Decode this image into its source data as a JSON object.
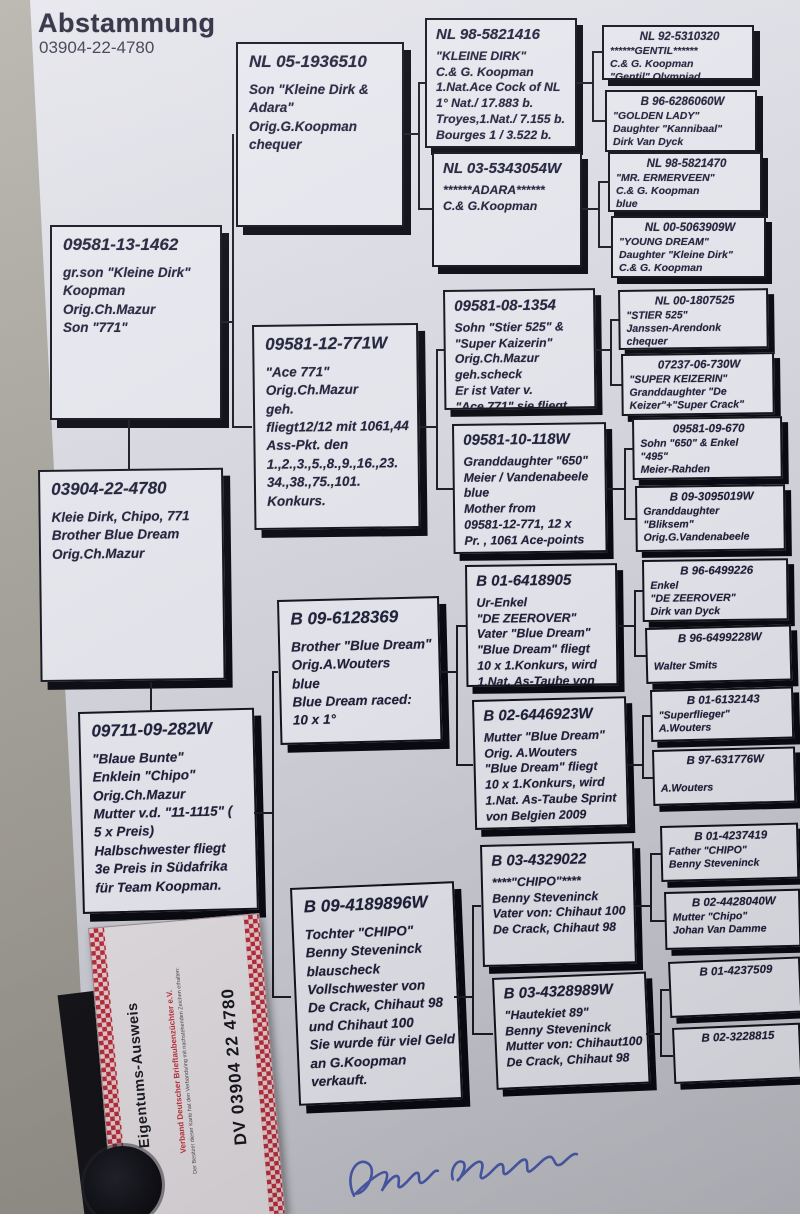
{
  "title": {
    "heading": "Abstammung",
    "ring_number": "03904-22-4780"
  },
  "colors": {
    "paper": "#dbdbe4",
    "box_border": "#14141e",
    "card_red": "#b8303c",
    "signature_blue": "#3c50aa"
  },
  "tree": {
    "sire": {
      "id": "09581-13-1462",
      "lines": [
        "gr.son \"Kleine Dirk\"",
        "Koopman",
        "Orig.Ch.Mazur",
        "Son \"771\""
      ]
    },
    "subject": {
      "id": "03904-22-4780",
      "lines": [
        "Kleie Dirk, Chipo, 771",
        "Brother Blue Dream",
        "Orig.Ch.Mazur"
      ]
    },
    "dam": {
      "id": "09711-09-282W",
      "lines": [
        "\"Blaue Bunte\"",
        "Enklein \"Chipo\"",
        "Orig.Ch.Mazur",
        "Mutter v.d. \"11-1115\" (",
        "5 x Preis)",
        "Halbschwester fliegt",
        "3e Preis in Südafrika",
        "für Team Koopman."
      ]
    },
    "g3": [
      {
        "id": "NL 05-1936510",
        "lines": [
          "Son \"Kleine Dirk &",
          "Adara\"",
          "Orig.G.Koopman",
          "chequer"
        ]
      },
      {
        "id": "09581-12-771W",
        "lines": [
          "\"Ace 771\"",
          "Orig.Ch.Mazur",
          "geh.",
          "fliegt12/12 mit 1061,44",
          "Ass-Pkt. den",
          "1.,2.,3.,5.,8.,9.,16.,23.",
          "34.,38.,75.,101.",
          "Konkurs."
        ]
      },
      {
        "id": "B 09-6128369",
        "lines": [
          "Brother \"Blue Dream\"",
          "Orig.A.Wouters",
          "blue",
          "Blue Dream raced:",
          "10 x 1°"
        ]
      },
      {
        "id": "B 09-4189896W",
        "lines": [
          "Tochter \"CHIPO\"",
          "Benny Steveninck",
          "blauscheck",
          "Vollschwester von",
          "De Crack, Chihaut 98",
          "und Chihaut 100",
          "Sie wurde für viel Geld",
          "an G.Koopman",
          "verkauft."
        ]
      }
    ],
    "g4": [
      {
        "id": "NL 98-5821416",
        "lines": [
          "\"KLEINE DIRK\"",
          "C.& G. Koopman",
          "1.Nat.Ace Cock of NL",
          "1° Nat./ 17.883 b.",
          "Troyes,1.Nat./ 7.155 b.",
          "Bourges 1 / 3.522 b."
        ]
      },
      {
        "id": "NL 03-5343054W",
        "lines": [
          "******ADARA******",
          "C.& G.Koopman"
        ]
      },
      {
        "id": "09581-08-1354",
        "lines": [
          "Sohn \"Stier 525\" &",
          "\"Super Kaizerin\"",
          "Orig.Ch.Mazur",
          "geh.scheck",
          "Er ist Vater v.",
          "\"Ace 771\" sie fliegt"
        ]
      },
      {
        "id": "09581-10-118W",
        "lines": [
          "Granddaughter \"650\"",
          "Meier / Vandenabeele",
          "blue",
          "Mother from",
          "09581-12-771, 12 x",
          "Pr. , 1061 Ace-points"
        ]
      },
      {
        "id": "B 01-6418905",
        "lines": [
          "Ur-Enkel",
          "\"DE ZEEROVER\"",
          "Vater \"Blue Dream\"",
          "\"Blue Dream\" fliegt",
          "10 x 1.Konkurs, wird",
          "1.Nat. As-Taube von"
        ]
      },
      {
        "id": "B 02-6446923W",
        "lines": [
          "Mutter \"Blue Dream\"",
          "Orig. A.Wouters",
          "\"Blue Dream\" fliegt",
          "10 x 1.Konkurs, wird",
          "1.Nat. As-Taube Sprint",
          "von Belgien 2009"
        ]
      },
      {
        "id": "B 03-4329022",
        "lines": [
          "****\"CHIPO\"****",
          "Benny Steveninck",
          "Vater von: Chihaut 100",
          "De Crack, Chihaut 98"
        ]
      },
      {
        "id": "B 03-4328989W",
        "lines": [
          "\"Hautekiet 89\"",
          "Benny Steveninck",
          "Mutter von: Chihaut100",
          "De Crack, Chihaut 98"
        ]
      }
    ],
    "g5": [
      {
        "id": "NL 92-5310320",
        "lines": [
          "******GENTIL******",
          "C.& G. Koopman",
          "\"Gentil\" Olympiad"
        ]
      },
      {
        "id": "B 96-6286060W",
        "lines": [
          "\"GOLDEN LADY\"",
          "Daughter \"Kannibaal\"",
          "Dirk Van Dyck"
        ]
      },
      {
        "id": "NL 98-5821470",
        "lines": [
          "\"MR. ERMERVEEN\"",
          "C.& G. Koopman",
          "blue"
        ]
      },
      {
        "id": "NL 00-5063909W",
        "lines": [
          "\"YOUNG DREAM\"",
          "Daughter \"Kleine Dirk\"",
          "C.& G. Koopman"
        ]
      },
      {
        "id": "NL 00-1807525",
        "lines": [
          "\"STIER 525\"",
          "Janssen-Arendonk",
          "chequer"
        ]
      },
      {
        "id": "07237-06-730W",
        "lines": [
          "\"SUPER KEIZERIN\"",
          "Granddaughter \"De",
          "Keizer\"+\"Super Crack\""
        ]
      },
      {
        "id": "09581-09-670",
        "lines": [
          "Sohn \"650\" & Enkel",
          "\"495\"",
          "Meier-Rahden"
        ]
      },
      {
        "id": "B 09-3095019W",
        "lines": [
          "Granddaughter",
          "\"Bliksem\"",
          "Orig.G.Vandenabeele"
        ]
      },
      {
        "id": "B 96-6499226",
        "lines": [
          "Enkel",
          "\"DE ZEEROVER\"",
          "Dirk van Dyck"
        ]
      },
      {
        "id": "B 96-6499228W",
        "lines": [
          "",
          "Walter Smits"
        ]
      },
      {
        "id": "B 01-6132143",
        "lines": [
          "\"Superflieger\"",
          "A.Wouters"
        ]
      },
      {
        "id": "B 97-631776W",
        "lines": [
          "",
          "A.Wouters"
        ]
      },
      {
        "id": "B 01-4237419",
        "lines": [
          "Father \"CHIPO\"",
          "Benny Steveninck"
        ]
      },
      {
        "id": "B 02-4428040W",
        "lines": [
          "Mutter \"Chipo\"",
          "Johan Van Damme"
        ]
      },
      {
        "id": "B 01-4237509",
        "lines": []
      },
      {
        "id": "B 02-3228815",
        "lines": []
      }
    ]
  },
  "card": {
    "title": "Eigentums-Ausweis",
    "org": "Verband Deutscher Brieftaubenzüchter e.V.",
    "note": "Der Besitzer dieser Karte hat den Verbandsring mit nachstehenden Zeichen erhalten:",
    "ring": "DV 03904 22 4780"
  }
}
